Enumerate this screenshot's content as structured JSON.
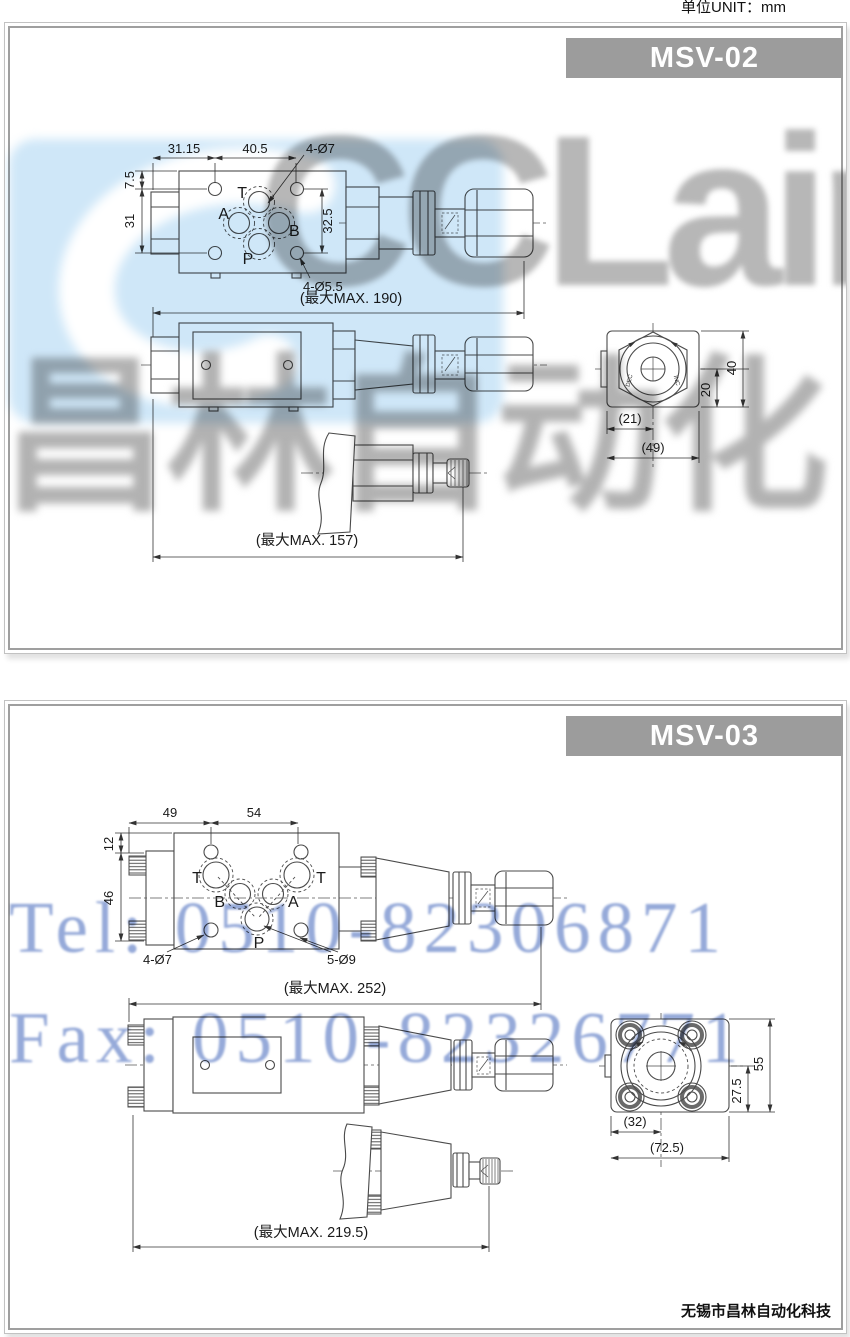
{
  "page": {
    "unit_label": "单位UNIT：mm",
    "footer_company": "无锡市昌林自动化科技",
    "header_bg_color": "#9c9c9c",
    "line_color": "#4a4a4a"
  },
  "watermark": {
    "logo_text": "CCLair",
    "brand_text": "昌林自动化",
    "tel_text": "Tel: 0510-82306871",
    "fax_text": "Fax: 0510-82326771",
    "blue_patch_color": "#cfe7f8",
    "gray_text_color": "#b5b5b5",
    "contact_text_color": "#96aad9"
  },
  "msv02": {
    "title": "MSV-02",
    "top": {
      "dim_w1": "31.15",
      "dim_w2": "40.5",
      "holes_top": "4-Ø7",
      "dim_h1": "7.5",
      "dim_h2": "31",
      "dim_h3": "32.5",
      "holes_bottom": "4-Ø5.5",
      "ports": [
        "T",
        "A",
        "B",
        "P"
      ]
    },
    "len_overall": "(最大MAX. 190)",
    "end": {
      "dim_a": "(21)",
      "dim_b": "(49)",
      "dim_c": "20",
      "dim_d": "40",
      "knob_dec": "DEC",
      "knob_inc": "INC"
    },
    "len_detail": "(最大MAX. 157)"
  },
  "msv03": {
    "title": "MSV-03",
    "top": {
      "dim_w1": "49",
      "dim_w2": "54",
      "dim_h1": "12",
      "dim_h2": "46",
      "holes_left": "4-Ø7",
      "holes_right": "5-Ø9",
      "ports": [
        "T",
        "B",
        "A",
        "T",
        "P"
      ]
    },
    "len_overall": "(最大MAX. 252)",
    "end": {
      "dim_a": "(32)",
      "dim_b": "(72.5)",
      "dim_c": "27.5",
      "dim_d": "55"
    },
    "len_detail": "(最大MAX. 219.5)"
  }
}
